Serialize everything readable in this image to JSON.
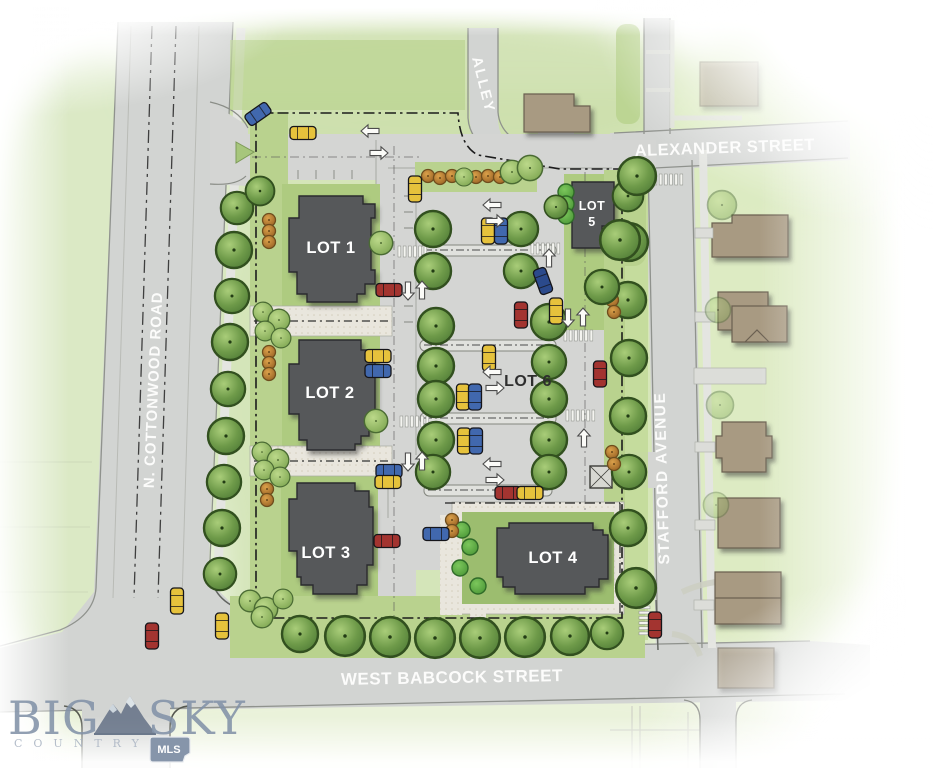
{
  "streets": {
    "alley": "ALLEY",
    "alexander": "ALEXANDER STREET",
    "cottonwood": "N. COTTONWOOD ROAD",
    "stafford": "STAFFORD AVENUE",
    "babcock": "WEST BABCOCK STREET"
  },
  "lots": {
    "lot1": "LOT 1",
    "lot2": "LOT 2",
    "lot3": "LOT 3",
    "lot4": "LOT 4",
    "lot5_line1": "LOT",
    "lot5_line2": "5",
    "lot6": "LOT 6"
  },
  "logo": {
    "word1": "BIG",
    "word2": "SKY",
    "tagline": "COUNTRY",
    "badge": "MLS"
  },
  "colors": {
    "building": "#57585a",
    "road": "#d2d4d2",
    "existing_house": "#a89a82",
    "lawn": "#b8d28d",
    "tree": "#6e9a49",
    "car_yellow": "#e6c23c",
    "car_red": "#a33430",
    "car_blue": "#4168ae",
    "logo_blue": "#8292a8"
  }
}
